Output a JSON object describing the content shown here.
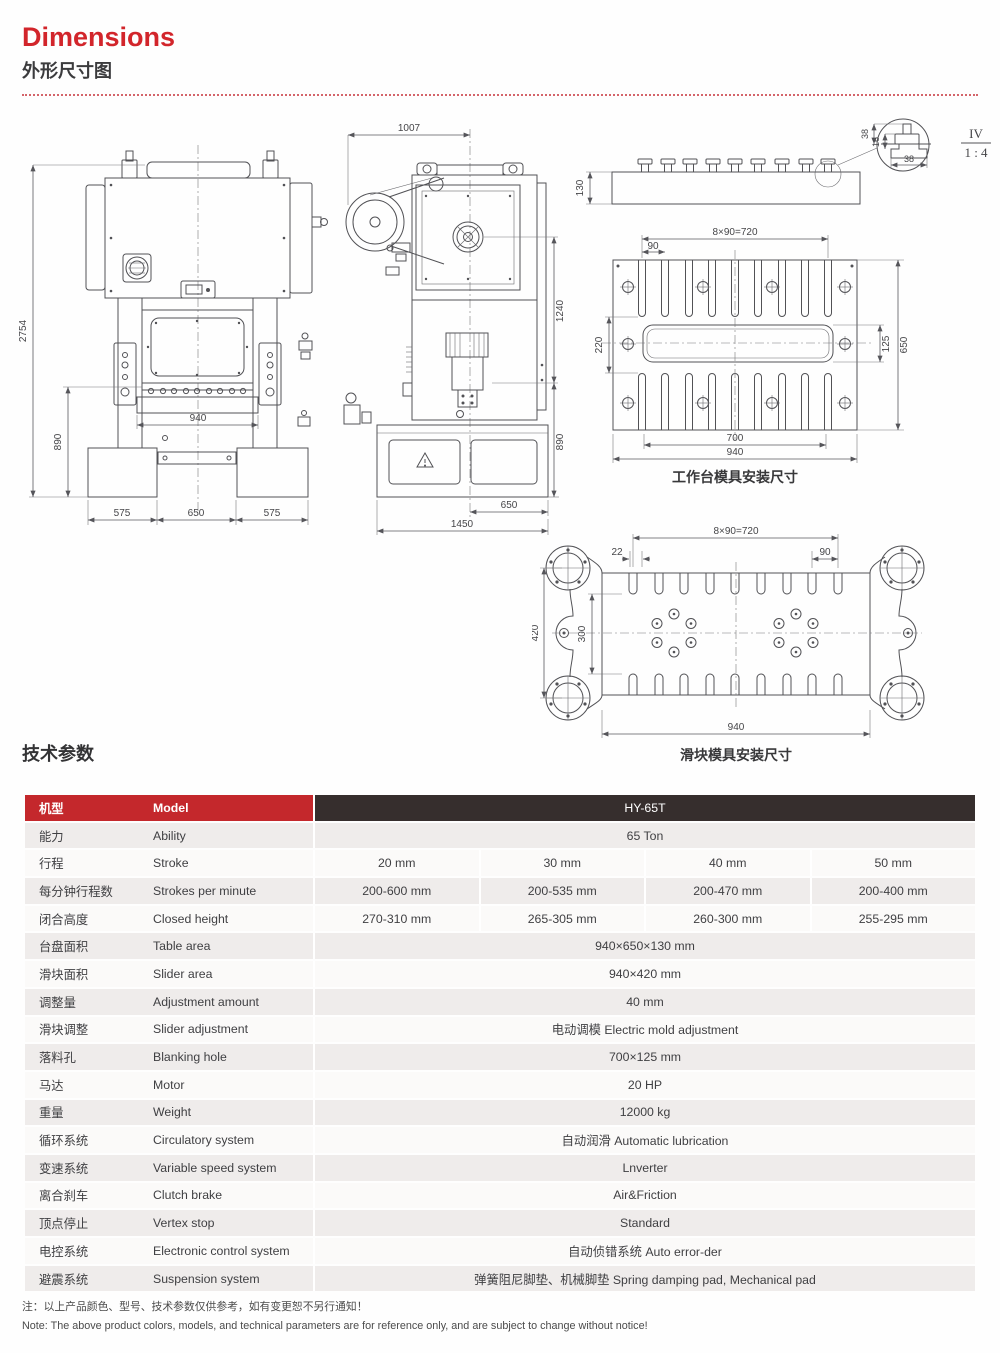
{
  "header": {
    "title": "Dimensions",
    "subtitle": "外形尺寸图"
  },
  "drawings": {
    "front": {
      "d2754": "2754",
      "d890": "890",
      "d940": "940",
      "d575l": "575",
      "d650": "650",
      "d575r": "575"
    },
    "side": {
      "d1007": "1007",
      "d1240": "1240",
      "d890": "890",
      "d650": "650",
      "d1450": "1450"
    },
    "profile": {
      "d130": "130",
      "d38a": "38",
      "d16": "16",
      "d38b": "38",
      "scale_num": "IV",
      "scale_den": "1 : 4"
    },
    "table_top": {
      "d720": "8×90=720",
      "d90": "90",
      "d220": "220",
      "d125": "125",
      "d650": "650",
      "d700": "700",
      "d940": "940",
      "caption": "工作台模具安装尺寸"
    },
    "slider": {
      "d720": "8×90=720",
      "d22": "22",
      "d90": "90",
      "d420": "420",
      "d300": "300",
      "d940": "940",
      "caption": "滑块模具安装尺寸"
    }
  },
  "specs": {
    "section_title": "技术参数",
    "model_row": {
      "cn": "机型",
      "en": "Model",
      "value": "HY-65T"
    },
    "rows": [
      {
        "cn": "能力",
        "en": "Ability",
        "values": [
          "65 Ton"
        ]
      },
      {
        "cn": "行程",
        "en": "Stroke",
        "values": [
          "20 mm",
          "30 mm",
          "40 mm",
          "50 mm"
        ]
      },
      {
        "cn": "每分钟行程数",
        "en": "Strokes per minute",
        "values": [
          "200-600 mm",
          "200-535 mm",
          "200-470 mm",
          "200-400 mm"
        ]
      },
      {
        "cn": "闭合高度",
        "en": "Closed height",
        "values": [
          "270-310 mm",
          "265-305 mm",
          "260-300 mm",
          "255-295 mm"
        ]
      },
      {
        "cn": "台盘面积",
        "en": "Table area",
        "values": [
          "940×650×130 mm"
        ]
      },
      {
        "cn": "滑块面积",
        "en": "Slider area",
        "values": [
          "940×420 mm"
        ]
      },
      {
        "cn": "调整量",
        "en": "Adjustment amount",
        "values": [
          "40 mm"
        ]
      },
      {
        "cn": "滑块调整",
        "en": "Slider adjustment",
        "values": [
          "电动调模 Electric mold adjustment"
        ]
      },
      {
        "cn": "落料孔",
        "en": "Blanking hole",
        "values": [
          "700×125 mm"
        ]
      },
      {
        "cn": "马达",
        "en": "Motor",
        "values": [
          "20 HP"
        ]
      },
      {
        "cn": "重量",
        "en": "Weight",
        "values": [
          "12000 kg"
        ]
      },
      {
        "cn": "循环系统",
        "en": "Circulatory system",
        "values": [
          "自动润滑 Automatic lubrication"
        ]
      },
      {
        "cn": "变速系统",
        "en": "Variable speed system",
        "values": [
          "Lnverter"
        ]
      },
      {
        "cn": "离合刹车",
        "en": "Clutch brake",
        "values": [
          "Air&Friction"
        ]
      },
      {
        "cn": "顶点停止",
        "en": "Vertex stop",
        "values": [
          "Standard"
        ]
      },
      {
        "cn": "电控系统",
        "en": "Electronic control system",
        "values": [
          "自动侦错系统 Auto error-der"
        ]
      },
      {
        "cn": "避震系统",
        "en": "Suspension system",
        "values": [
          "弹簧阻尼脚垫、机械脚垫 Spring damping pad, Mechanical pad"
        ]
      }
    ]
  },
  "notes": {
    "cn": "注：以上产品颜色、型号、技术参数仅供参考，如有变更恕不另行通知！",
    "en": "Note: The above product colors, models, and technical parameters are for reference only, and are subject to change without notice!"
  },
  "colors": {
    "accent_red": "#c4282c",
    "header_dark": "#362e2d",
    "row_shade": "#efeceb",
    "title_red": "#d2252b"
  }
}
